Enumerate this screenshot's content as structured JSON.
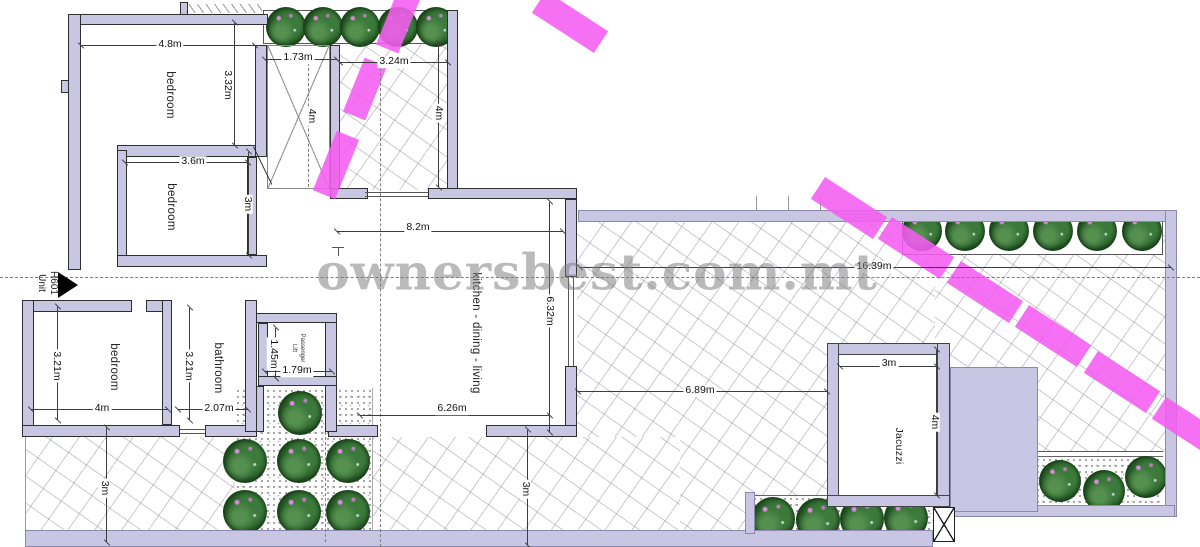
{
  "watermark_text": "ownersbest.com.mt",
  "unit_label": {
    "name": "Unit",
    "number": "H601"
  },
  "room_labels": {
    "bedroom1": "bedroom",
    "bedroom2": "bedroom",
    "bedroom3": "bedroom",
    "bathroom": "bathroom",
    "living": "kitchen - dining - living",
    "lift_line1": "Passenger",
    "lift_line2": "Lift",
    "jacuzzi": "Jacuzzi"
  },
  "dims": {
    "bedroom1_w": "4.8m",
    "bedroom1_h": "3.32m",
    "shaft_w": "1.73m",
    "shaft_h": "4m",
    "terrace_top_w": "3.24m",
    "terrace_top_h": "4m",
    "living_w_top": "8.2m",
    "living_h": "6.32m",
    "living_w_bottom": "6.26m",
    "bedroom2_w": "3.6m",
    "bedroom2_h": "3m",
    "bedroom3_h": "3.21m",
    "bedroom3_w": "4m",
    "bathroom_h": "3.21m",
    "bathroom_w": "2.07m",
    "lift_h": "1.45m",
    "lift_w": "1.79m",
    "terrace_w": "16.39m",
    "terrace_d": "6.89m",
    "jacuzzi_w": "3m",
    "jacuzzi_h": "4m",
    "terrace_left_d": "3m",
    "terrace_bottom_d": "3m"
  },
  "colors": {
    "wall_fill": "#c9c6e4",
    "highlight_pink": "#f45cf0",
    "tree_green": "#2e642e",
    "watermark_gray": "#7a7a7a"
  }
}
